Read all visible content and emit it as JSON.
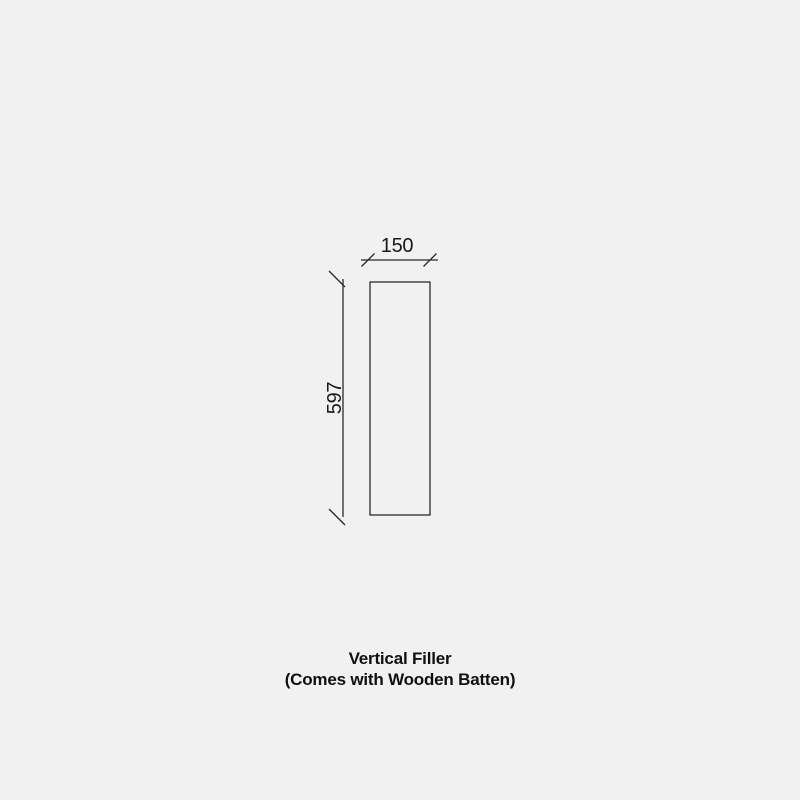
{
  "page": {
    "background_color": "#f1f1f1",
    "line_color": "#2a2a2a",
    "text_color": "#101010"
  },
  "diagram": {
    "type": "technical-dimension-drawing",
    "part_outline": "tall narrow rectangle (front view of filler panel)",
    "width_dimension": {
      "label": "150",
      "value": 150,
      "position": "top",
      "tick_style": "oblique-slash"
    },
    "height_dimension": {
      "label": "597",
      "value": 597,
      "position": "left",
      "tick_style": "oblique-slash",
      "label_rotation": "90deg counter-clockwise"
    }
  },
  "caption": {
    "title": "Vertical Filler",
    "subtitle": "(Comes with Wooden Batten)"
  }
}
